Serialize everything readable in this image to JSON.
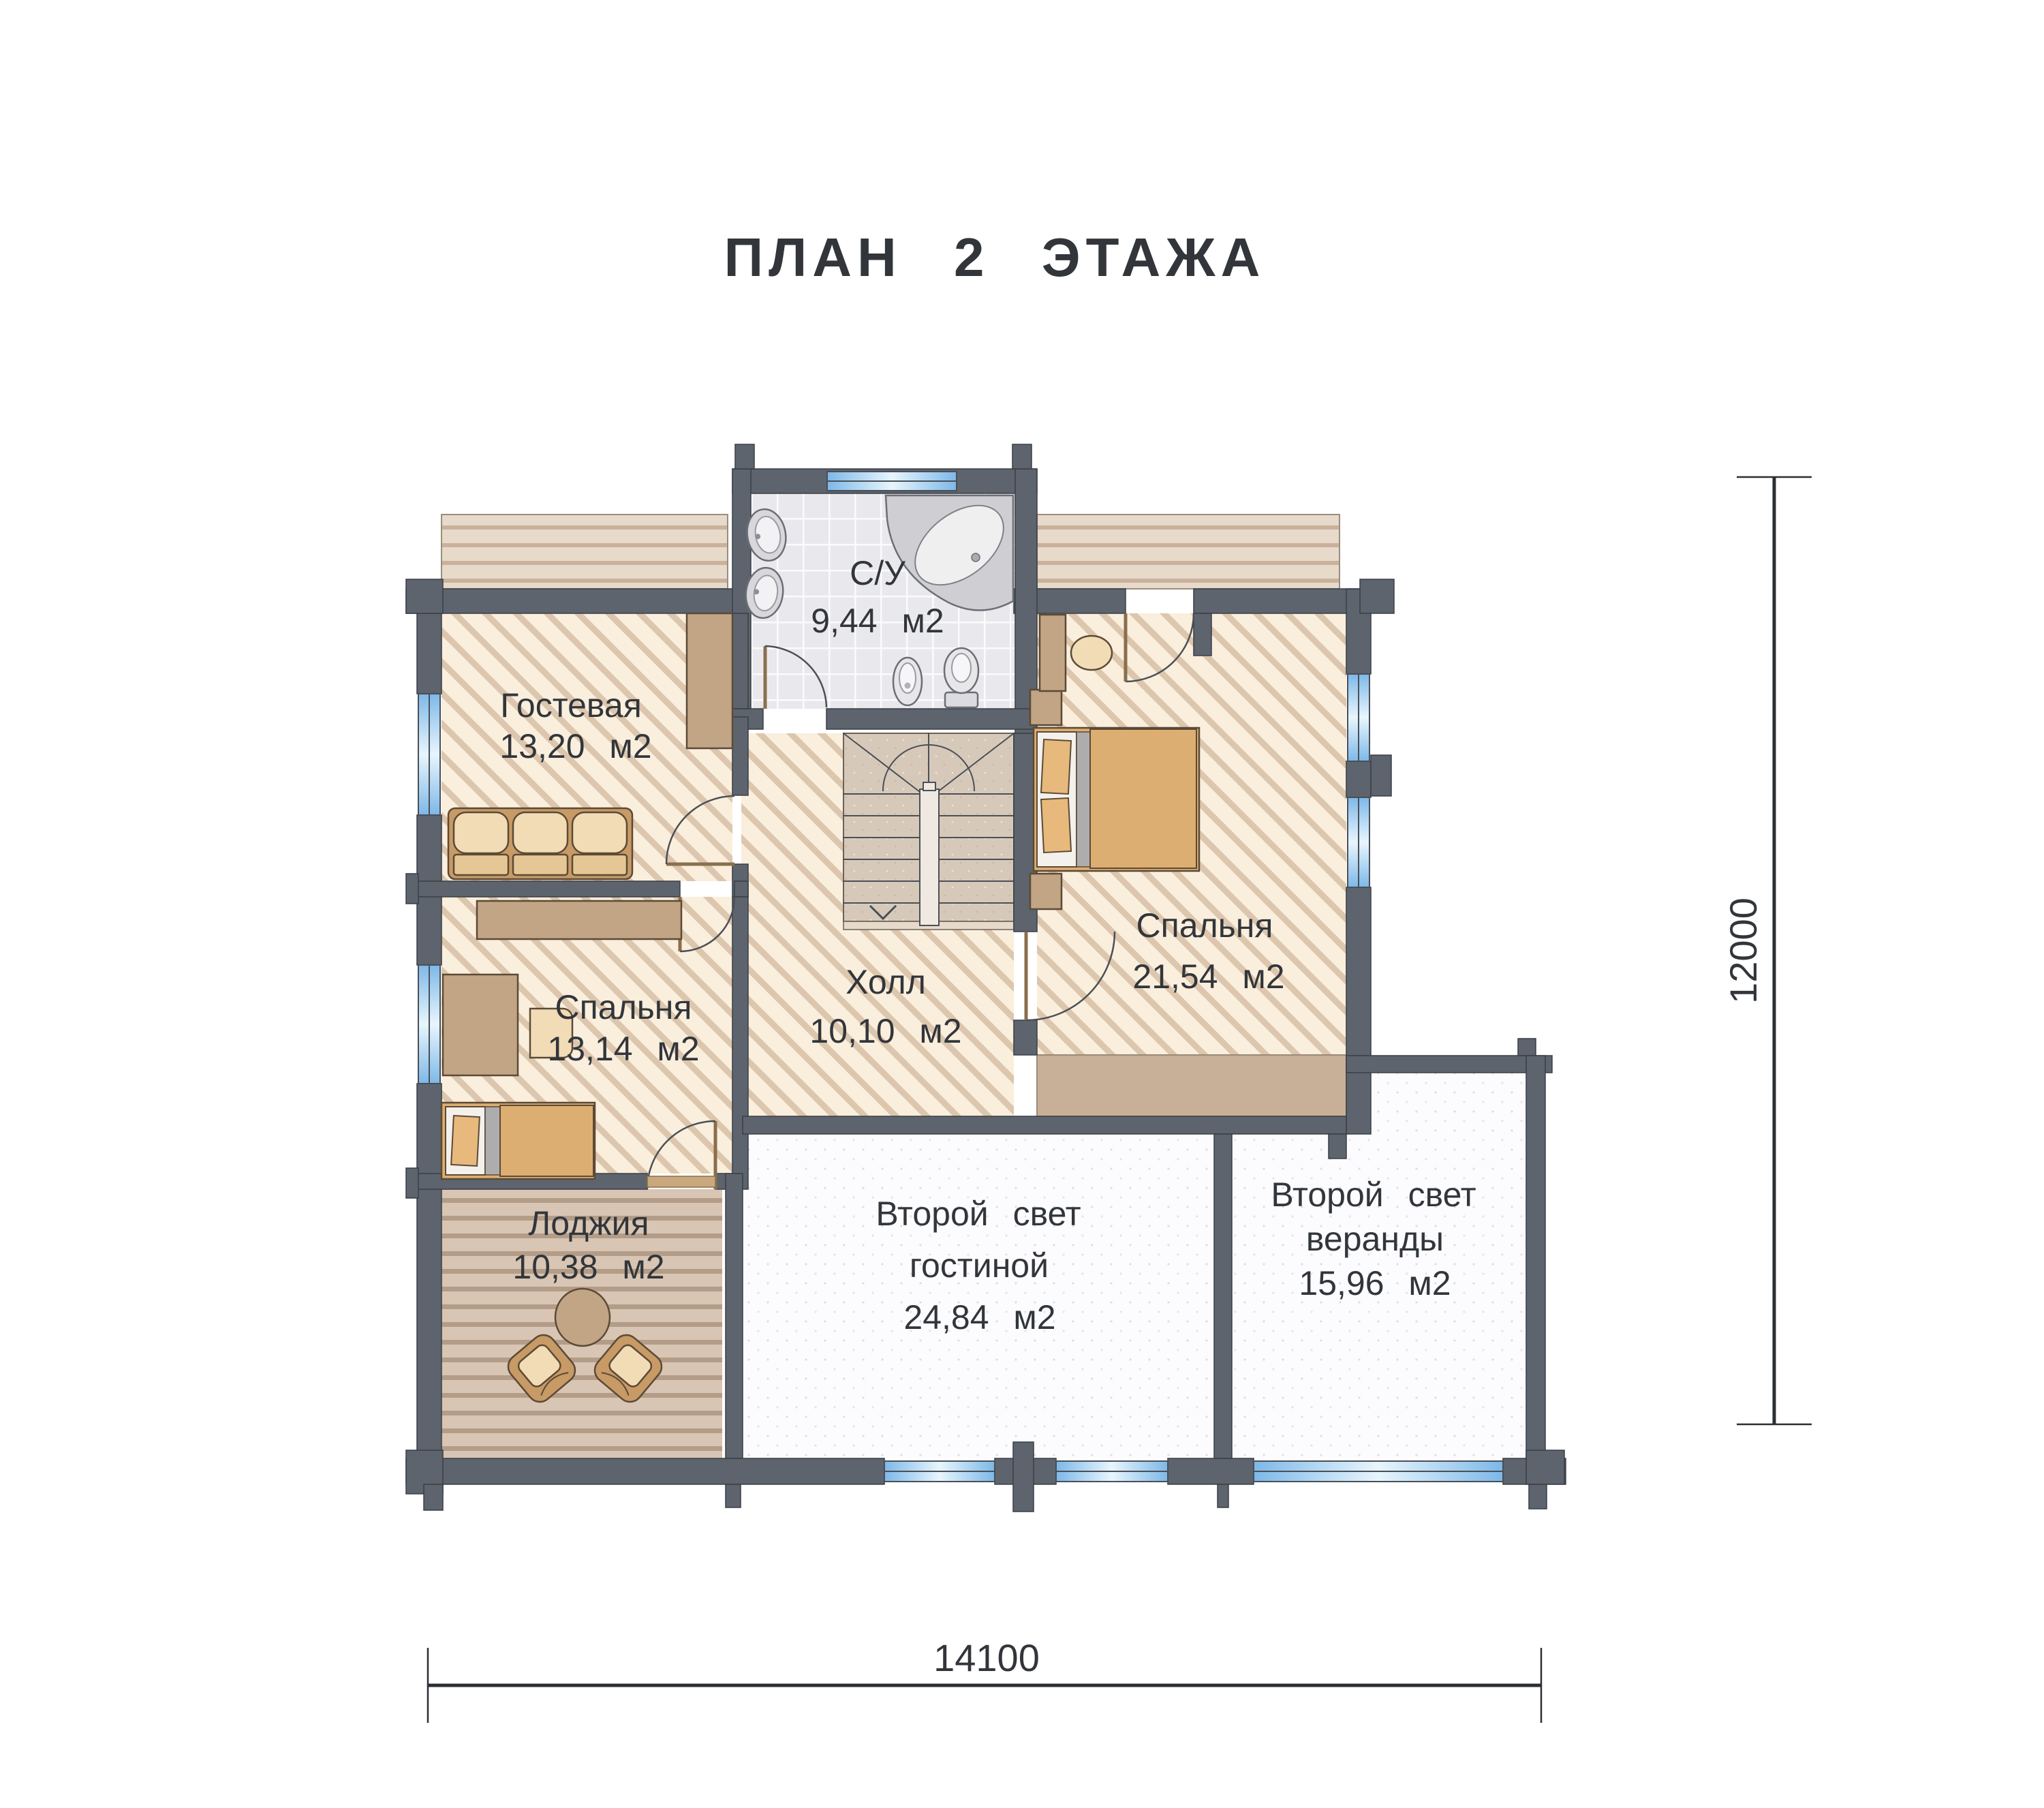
{
  "title": "ПЛАН  2  ЭТАЖА",
  "rooms": {
    "bathroom": {
      "name": "С/У",
      "area": "9,44  м2"
    },
    "guest": {
      "name": "Гостевая",
      "area": "13,20  м2"
    },
    "bedroom_big": {
      "name": "Спальня",
      "area": "21,54  м2"
    },
    "hall": {
      "name": "Холл",
      "area": "10,10  м2"
    },
    "bedroom_small": {
      "name": "Спальня",
      "area": "13,14  м2"
    },
    "loggia": {
      "name": "Лоджия",
      "area": "10,38  м2"
    },
    "void_living": {
      "line1": "Второй  свет",
      "line2": "гостиной",
      "area": "24,84  м2"
    },
    "void_veranda": {
      "line1": "Второй  свет",
      "line2": "веранды",
      "area": "15,96  м2"
    }
  },
  "dimensions": {
    "width_label": "14100",
    "height_label": "12000"
  },
  "colors": {
    "wall": "#5d646d",
    "floor_hatch_base": "#faeedd",
    "floor_hatch_stripe": "#dcc6ad",
    "tile_floor": "#eaeaee",
    "wood_loggia": "#d8c5b3",
    "wood_terrace": "#e7dacb",
    "void_floor": "#fcfcfe",
    "window_glass": "#8ec3ee",
    "furniture_wood": "#c79a66",
    "cushion": "#f1dcb6",
    "mattress": "#ddae72",
    "band": "#c8b098",
    "text": "#32363b"
  }
}
